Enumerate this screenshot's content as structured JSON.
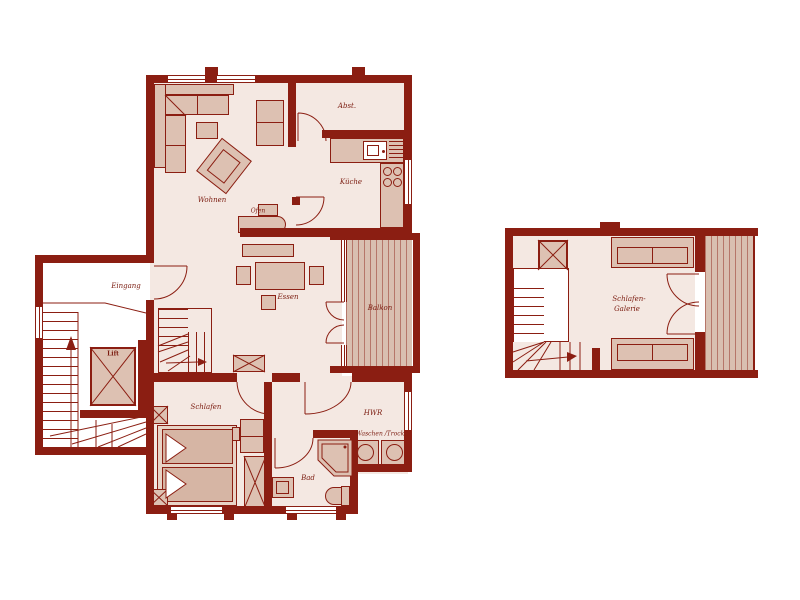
{
  "document_type": "apartment floor plan, two levels",
  "colors": {
    "wall": "#8b1e12",
    "floor": "#f4e8e2",
    "furniture": "#ddc1b2",
    "furniture_dark": "#d6b5a4",
    "deck": "#d9bfb0",
    "label_text": "#7a1a0e",
    "background": "#ffffff"
  },
  "ground_floor": {
    "labels": {
      "wohnen": "Wohnen",
      "kueche": "Küche",
      "abstellraum": "Abst.",
      "ofen": "Ofen",
      "essen": "Essen",
      "eingang": "Eingang",
      "lift": "Lift",
      "balkon": "Balkon",
      "schlafen": "Schlafen",
      "hwr": "HWR",
      "waschen_trocknen": "Waschen /Trock.",
      "bad": "Bad"
    }
  },
  "upper_floor": {
    "labels": {
      "schlafen_galerie_line1": "Schlafen-",
      "schlafen_galerie_line2": "Galerie"
    }
  }
}
